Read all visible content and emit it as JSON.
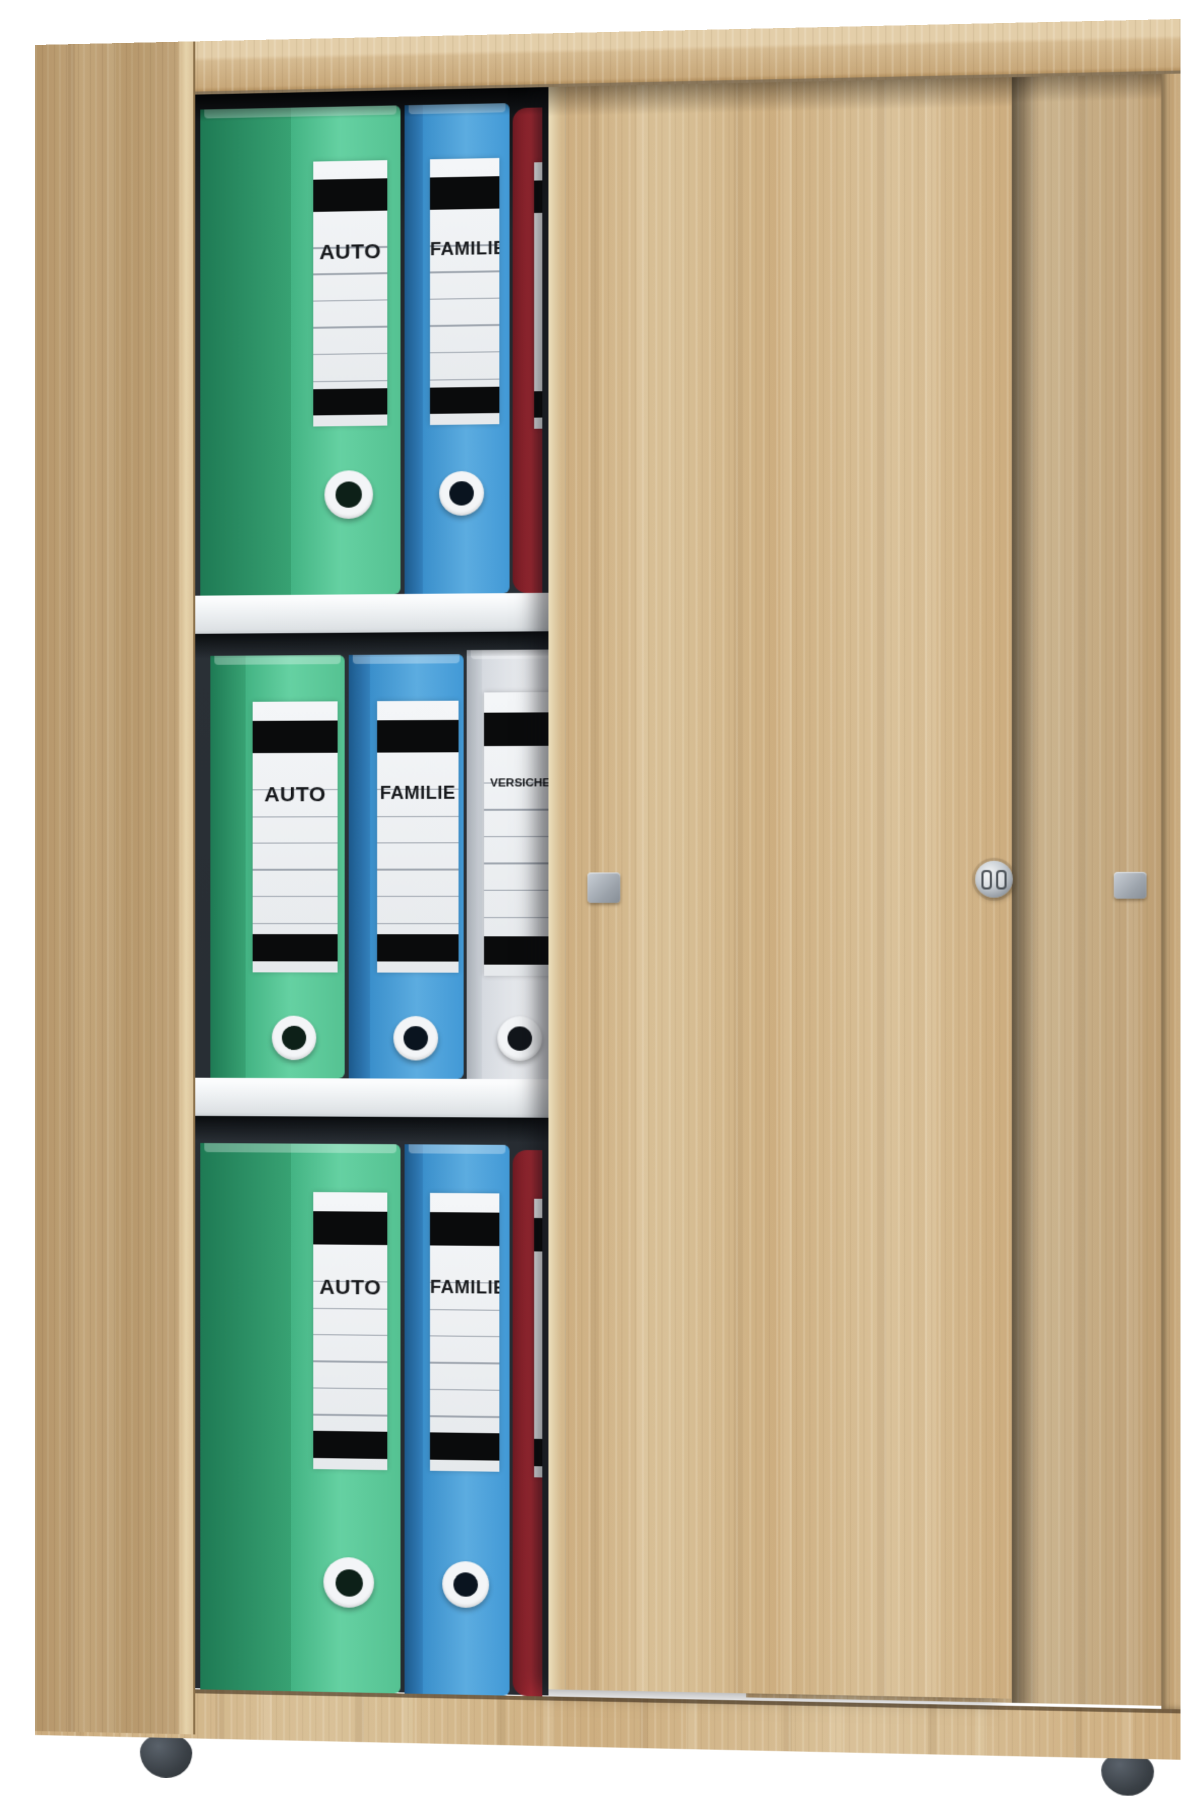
{
  "scene": {
    "type": "product-photo",
    "subject": "Office filing cabinet with two sliding doors, partially open, filled with lever-arch ring binders",
    "background_color": "#ffffff"
  },
  "cabinet": {
    "wood_finish": "sonoma-oak",
    "wood_color": "#d0b186",
    "interior_color": "#262b31",
    "shelf_color": "#eef1f3",
    "shelf_count": 2,
    "compartment_count": 3,
    "doors": {
      "count": 2,
      "state": "front door slid right, left compartments visible",
      "handle_count": 2,
      "handle_color": "#a9b0b8",
      "lock_present": true,
      "lock_color": "#c4cad0"
    },
    "feet": {
      "count": 2,
      "color": "#3a4046"
    }
  },
  "shelves": [
    {
      "position": "top",
      "binders": [
        {
          "color_name": "green",
          "color": "#55c292",
          "label": "AUTO"
        },
        {
          "color_name": "blue",
          "color": "#4299d6",
          "label": "FAMILIE"
        },
        {
          "color_name": "red",
          "color": "#a32a34",
          "label": ""
        }
      ]
    },
    {
      "position": "middle",
      "binders": [
        {
          "color_name": "green",
          "color": "#55c292",
          "label": "AUTO"
        },
        {
          "color_name": "blue",
          "color": "#4299d6",
          "label": "FAMILIE"
        },
        {
          "color_name": "white",
          "color": "#e4e7eb",
          "label": "VERSICHERUNG"
        }
      ]
    },
    {
      "position": "bottom",
      "binders": [
        {
          "color_name": "green",
          "color": "#55c292",
          "label": "AUTO"
        },
        {
          "color_name": "blue",
          "color": "#4299d6",
          "label": "FAMILIE"
        },
        {
          "color_name": "red",
          "color": "#a32a34",
          "label": ""
        }
      ]
    }
  ],
  "binder_label_style": {
    "sticker_color": "#eef0f3",
    "bar_color": "#0a0b0c",
    "rule_color": "#a0a7b0",
    "text_color": "#17191c"
  }
}
